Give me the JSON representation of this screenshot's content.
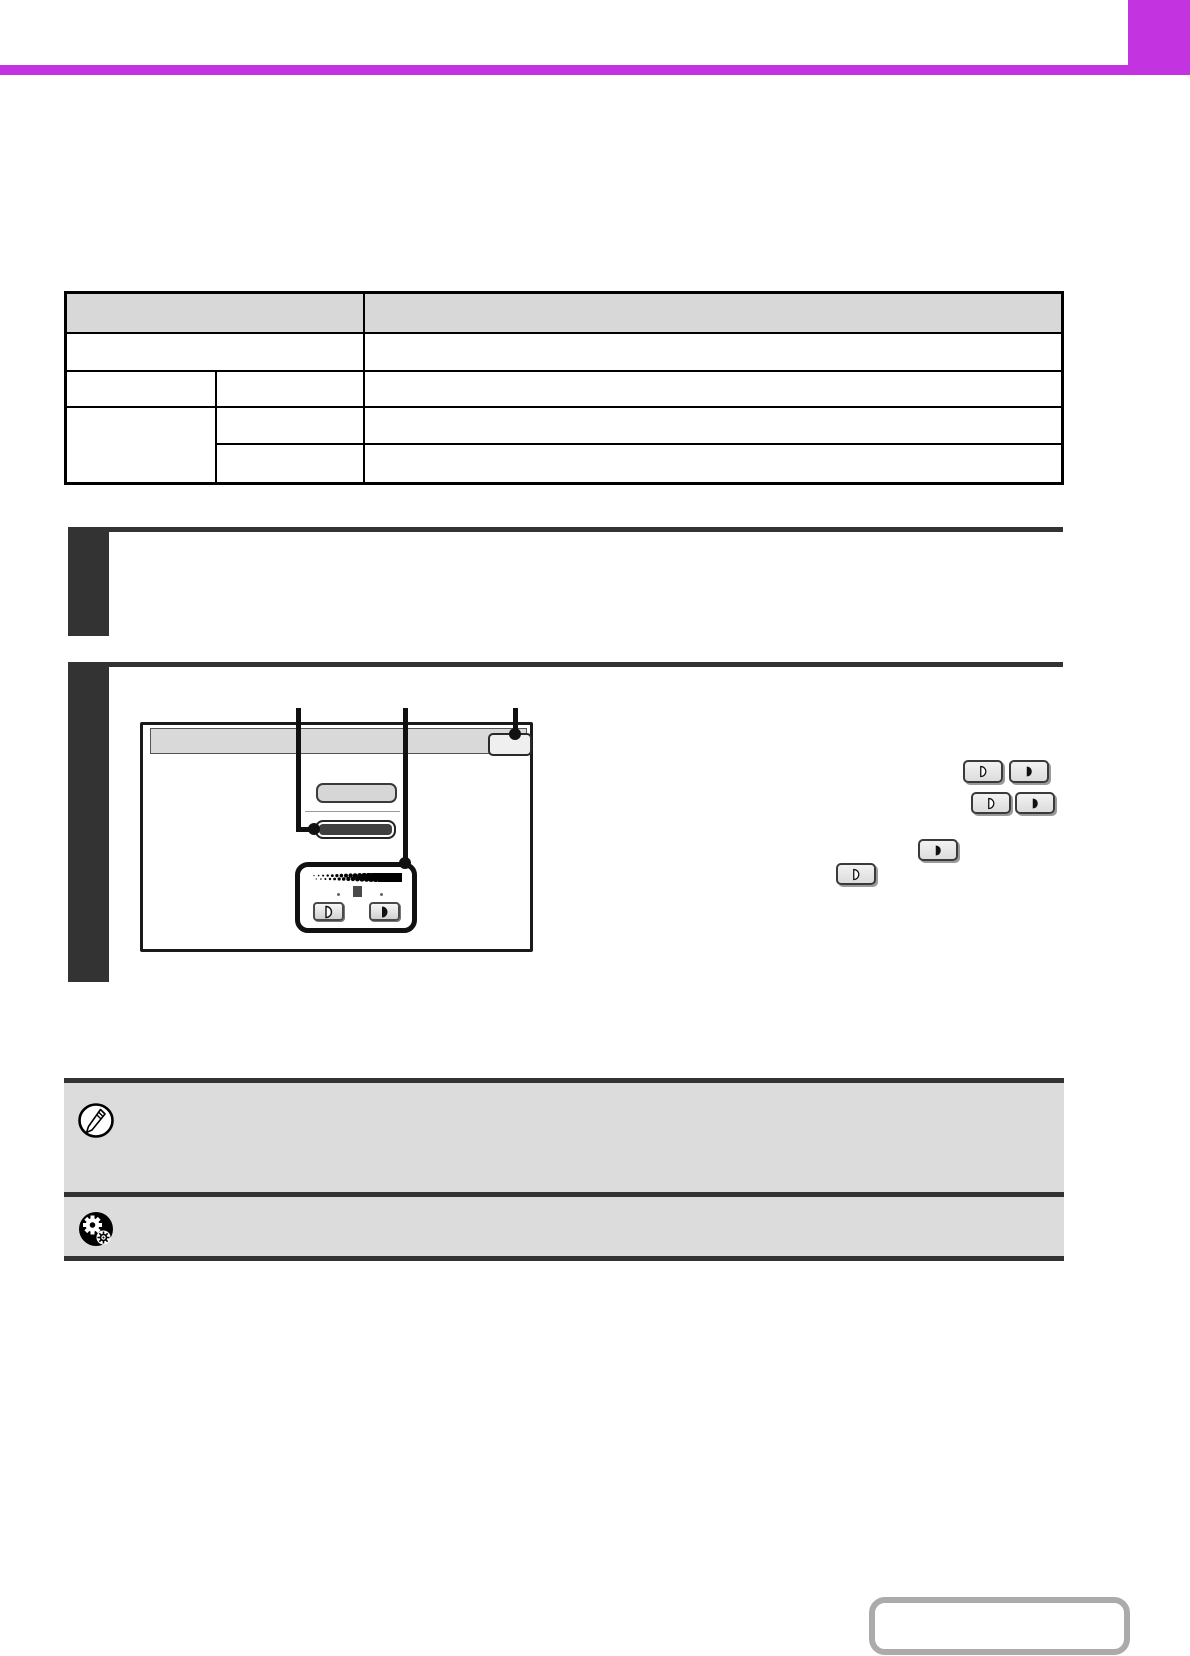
{
  "page": {
    "kind": "manual-page-with-unrendered-text",
    "accent_color": "#c433e0",
    "step_marker_color": "#333333",
    "note_band_color": "#dcdcdc",
    "table_header_fill": "#d8d8d8",
    "dark_key_color": "#3f3f3f",
    "page_box_border_color": "#ababab"
  },
  "header": {
    "tab_label": "",
    "title": ""
  },
  "table": {
    "header_labels": [
      "",
      ""
    ],
    "rows": [
      {
        "cells": [
          "",
          ""
        ]
      },
      {
        "cells": [
          "",
          "",
          ""
        ]
      },
      {
        "cells": [
          "",
          ""
        ]
      },
      {
        "cells": [
          "",
          ""
        ]
      }
    ]
  },
  "steps": [
    {
      "number_label": ""
    },
    {
      "number_label": ""
    }
  ],
  "screen_mockup": {
    "title_bar_label": "",
    "ok_button_label": "",
    "auto_button_label": "",
    "manual_button_label": "",
    "lighten_icon": "half-disc-outline-icon",
    "darken_icon": "half-disc-filled-icon"
  },
  "inline_keys": [
    {
      "icon": "lighten-key"
    },
    {
      "icon": "darken-key"
    },
    {
      "icon": "lighten-key"
    },
    {
      "icon": "darken-key"
    },
    {
      "icon": "darken-key"
    },
    {
      "icon": "lighten-key"
    }
  ],
  "notes": [
    {
      "icon": "pencil-note-icon",
      "text": ""
    },
    {
      "icon": "gears-settings-icon",
      "text": ""
    }
  ],
  "footer": {
    "page_link_label": ""
  }
}
